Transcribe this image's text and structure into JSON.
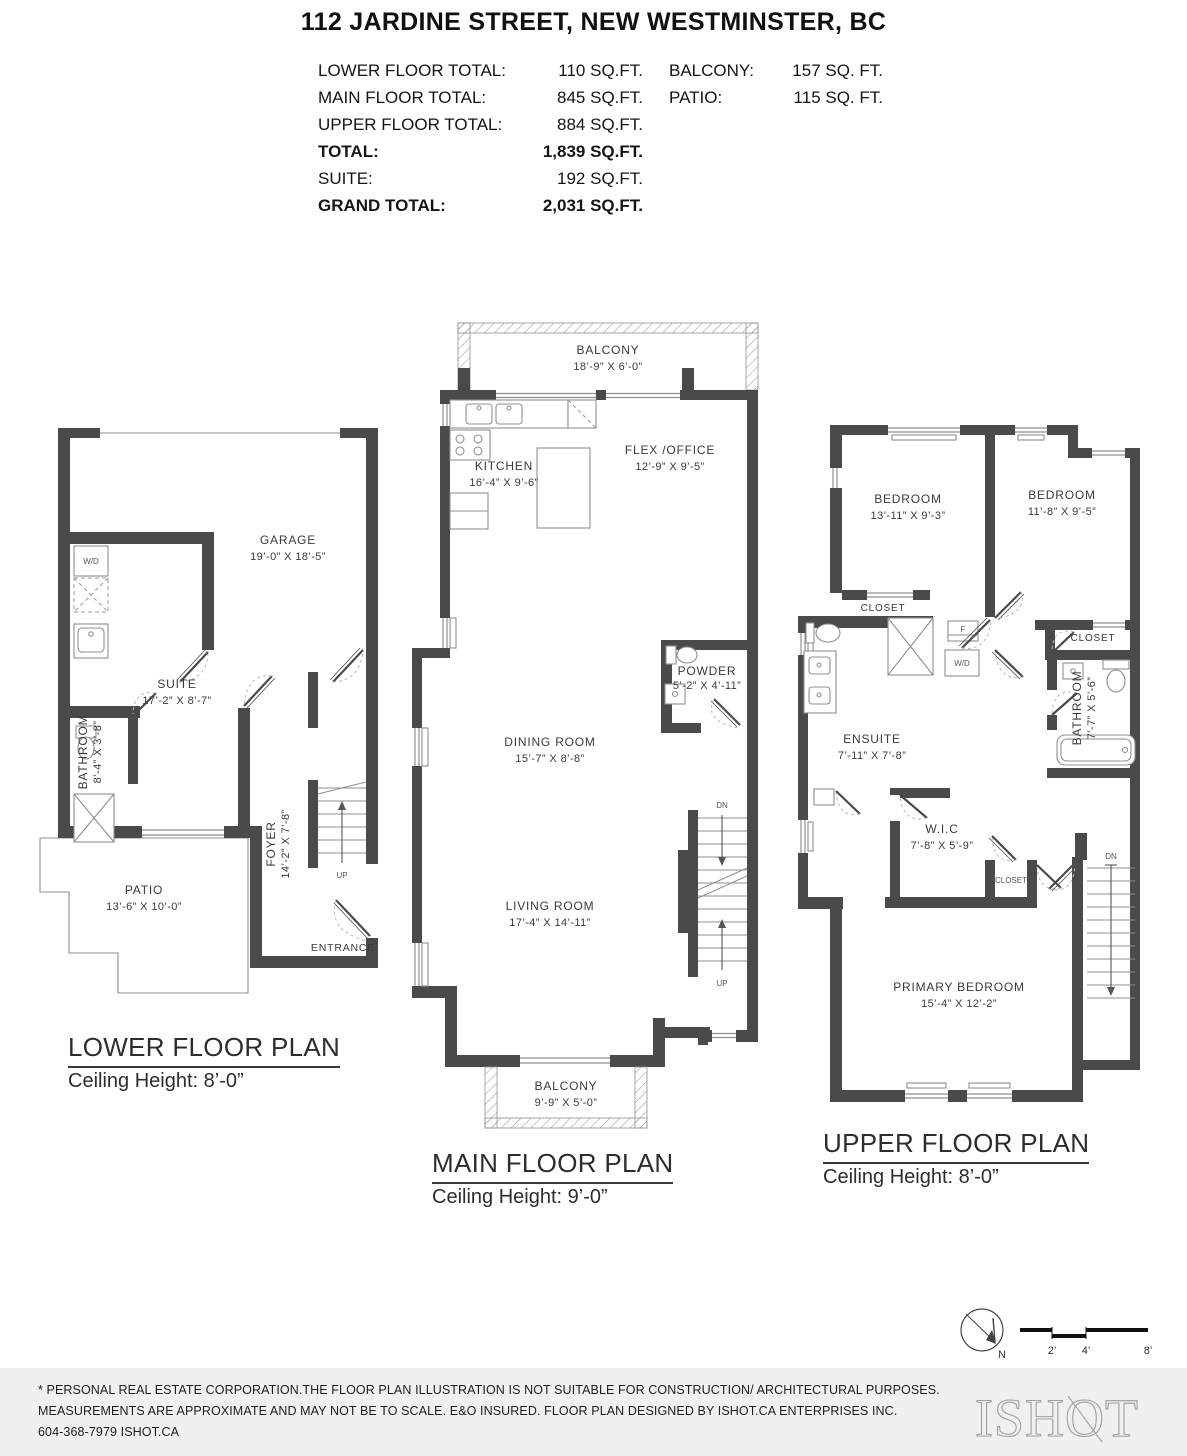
{
  "header": {
    "title": "112 JARDINE STREET, NEW WESTMINSTER, BC",
    "summary": {
      "rows": [
        {
          "l": "LOWER FLOOR TOTAL:",
          "v": "110 SQ.FT.",
          "rl": "BALCONY:",
          "rv": "157 SQ. FT."
        },
        {
          "l": "MAIN FLOOR TOTAL:",
          "v": "845 SQ.FT.",
          "rl": "PATIO:",
          "rv": "115 SQ. FT."
        },
        {
          "l": "UPPER FLOOR TOTAL:",
          "v": "884 SQ.FT."
        },
        {
          "l": "TOTAL:",
          "v": "1,839 SQ.FT."
        },
        {
          "l": "SUITE:",
          "v": "192 SQ.FT."
        },
        {
          "l": "GRAND TOTAL:",
          "v": "2,031 SQ.FT."
        }
      ]
    }
  },
  "lower": {
    "title": "LOWER FLOOR PLAN",
    "subtitle": "Ceiling Height: 8’-0”",
    "garage_name": "GARAGE",
    "garage_dims": "19’-0” X 18’-5”",
    "suite_name": "SUITE",
    "suite_dims": "17’-2” X 8’-7”",
    "bathroom_name": "BATHROOM",
    "bathroom_dims": "8’-4” X 3’-8”",
    "foyer_name": "FOYER",
    "foyer_dims": "14’-2” X 7’-8”",
    "patio_name": "PATIO",
    "patio_dims": "13’-6” X 10’-0”",
    "entrance": "ENTRANCE",
    "wd": "W/D",
    "up": "UP"
  },
  "main": {
    "title": "MAIN FLOOR PLAN",
    "subtitle": "Ceiling Height: 9’-0”",
    "balcony_top_name": "BALCONY",
    "balcony_top_dims": "18’-9” X 6’-0”",
    "kitchen_name": "KITCHEN",
    "kitchen_dims": "16’-4” X 9’-6”",
    "flex_name": "FLEX /OFFICE",
    "flex_dims": "12’-9” X 9’-5”",
    "powder_name": "POWDER",
    "powder_dims": "5’-2” X 4’-11”",
    "dining_name": "DINING ROOM",
    "dining_dims": "15’-7” X 8’-8”",
    "living_name": "LIVING ROOM",
    "living_dims": "17’-4” X 14’-11”",
    "balcony_bottom_name": "BALCONY",
    "balcony_bottom_dims": "9’-9” X 5’-0”",
    "dn": "DN",
    "up": "UP"
  },
  "upper": {
    "title": "UPPER FLOOR PLAN",
    "subtitle": "Ceiling Height: 8’-0”",
    "bedroom1_name": "BEDROOM",
    "bedroom1_dims": "13’-11” X 9’-3”",
    "bedroom2_name": "BEDROOM",
    "bedroom2_dims": "11’-8” X 9’-5”",
    "closet_right": "CLOSET",
    "closet_left": "CLOSET",
    "closet_small": "CLOSET",
    "bathroom_name": "BATHROOM",
    "bathroom_dims": "7’-7” X 5’-6”",
    "ensuite_name": "ENSUITE",
    "ensuite_dims": "7’-11” X 7’-8”",
    "wic_name": "W.I.C",
    "wic_dims": "7’-8” X 5’-9”",
    "primary_name": "PRIMARY BEDROOM",
    "primary_dims": "15’-4” X 12’-2”",
    "f": "F",
    "wd": "W/D",
    "dn": "DN"
  },
  "scalebar": {
    "n": "N",
    "t2": "2’",
    "t4": "4’",
    "t8": "8’"
  },
  "footer": {
    "line1": "* PERSONAL REAL ESTATE CORPORATION.THE FLOOR PLAN ILLUSTRATION IS NOT SUITABLE FOR CONSTRUCTION/ ARCHITECTURAL PURPOSES.",
    "line2": "MEASUREMENTS ARE APPROXIMATE AND MAY NOT BE TO SCALE. E&O INSURED. FLOOR PLAN DESIGNED BY ISHOT.CA ENTERPRISES INC.",
    "line3": "604-368-7979  ISHOT.CA",
    "logo": "ISHOT"
  }
}
